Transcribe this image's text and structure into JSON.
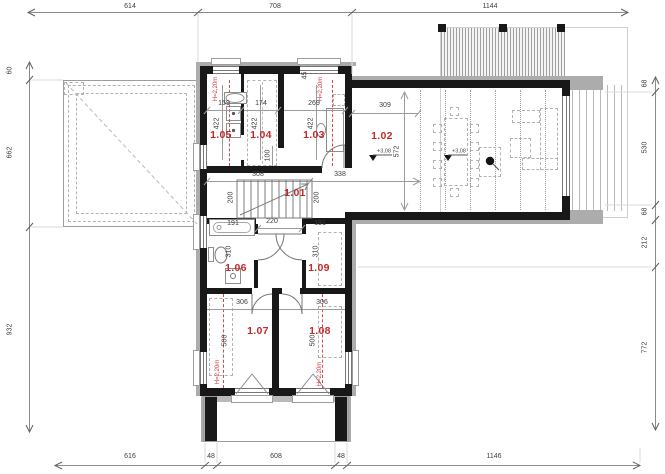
{
  "plan_type": "floor-plan-upper-storey",
  "colors": {
    "accent_red": "#c22b2b",
    "wall_black": "#181818",
    "trim_gray": "#acacac"
  },
  "rooms": {
    "r101": "1.01",
    "r102": "1.02",
    "r103": "1.03",
    "r104": "1.04",
    "r105": "1.05",
    "r106": "1.06",
    "r107": "1.07",
    "r108": "1.08",
    "r109": "1.09"
  },
  "notes": {
    "h220": "H=2,20m",
    "level": "+3,08"
  },
  "dims": {
    "top": [
      "614",
      "708",
      "1144"
    ],
    "bottom": [
      "616",
      "48",
      "608",
      "48",
      "1146"
    ],
    "left": [
      "60",
      "662",
      "932"
    ],
    "right": [
      "68",
      "530",
      "68",
      "212",
      "772"
    ],
    "w105": "159",
    "w104": "174",
    "w103": "269",
    "h_top_band": "422",
    "win103": "45",
    "gap100": "100",
    "hall_a": "308",
    "hall_b": "338",
    "hall_h": "200",
    "living_a": "309",
    "living_b": "572",
    "tub": "191",
    "corridor": "220",
    "w109": "191",
    "h_mid_band": "310",
    "w107": "306",
    "w108": "306",
    "h_bot_band": "500"
  }
}
